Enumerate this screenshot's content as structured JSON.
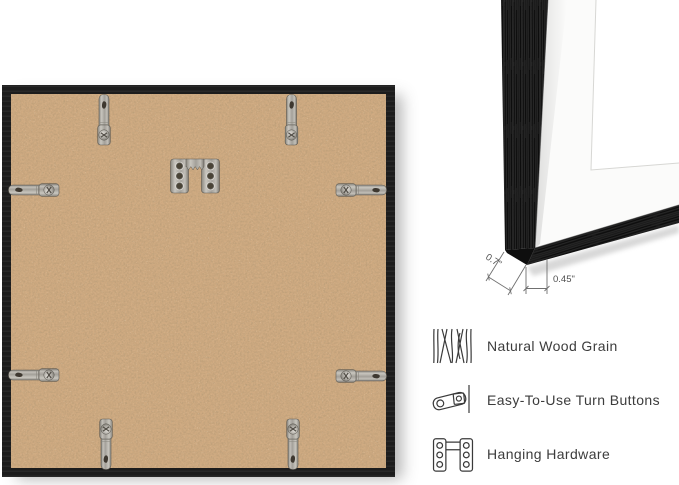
{
  "canvas": {
    "background": "#ffffff"
  },
  "back_view": {
    "description": "back of square black picture frame",
    "frame_color": "#1c1c1c",
    "backing_color": "#d0ab82",
    "hardware": {
      "turn_button_count": 8,
      "sawtooth_hanger_count": 1,
      "metal_color": "#b3b0a9"
    }
  },
  "corner_view": {
    "description": "front corner of black frame with white mat",
    "frame_color": "#181818",
    "mat_color": "#fbfbfa",
    "line_color": "#707070",
    "dimensions": [
      {
        "label": "0.7\""
      },
      {
        "label": "0.45\""
      }
    ]
  },
  "features": [
    {
      "icon": "wood-grain-icon",
      "label": "Natural Wood Grain"
    },
    {
      "icon": "turn-button-icon",
      "label": "Easy-To-Use Turn Buttons"
    },
    {
      "icon": "hanging-hardware-icon",
      "label": "Hanging Hardware"
    }
  ],
  "text_color": "#3c3c3c"
}
